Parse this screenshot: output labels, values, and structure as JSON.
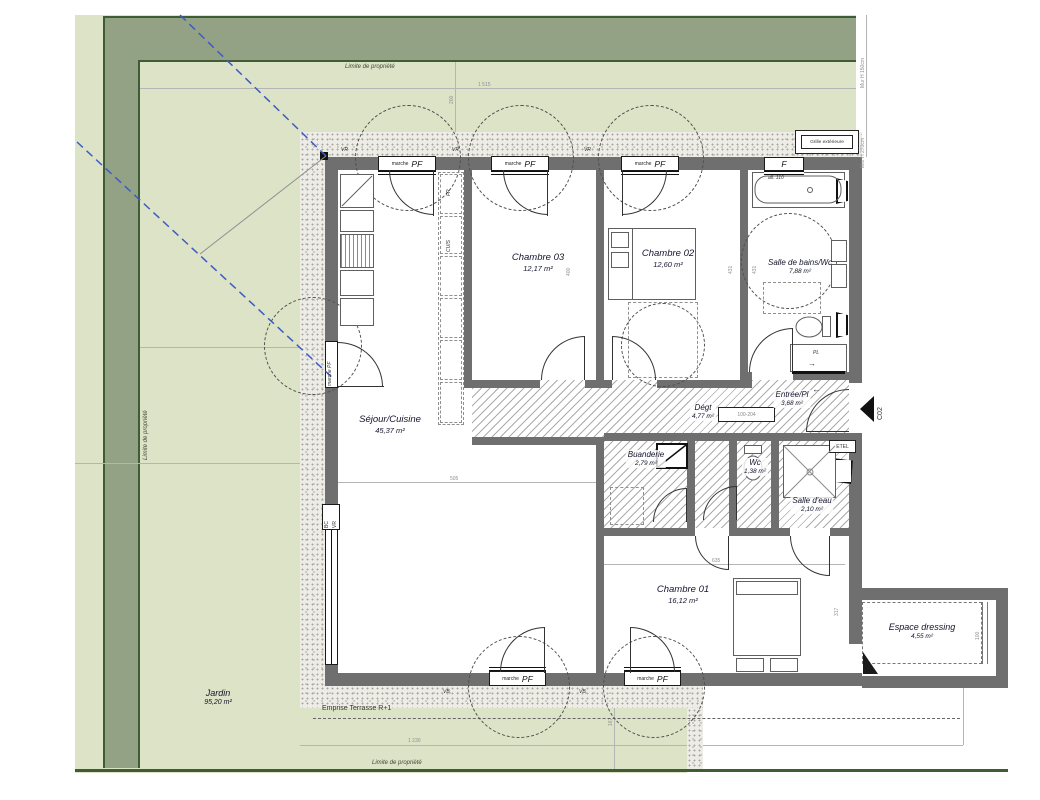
{
  "garden": {
    "name": "Jardin",
    "area": "95,20 m²"
  },
  "property_limit": {
    "top": "Limite de propriété",
    "left": "Limite de propriété",
    "bottom": "Limite de propriété"
  },
  "terrace": {
    "emprise_label": "Emprise Terrasse R+1"
  },
  "rooms": {
    "sejour": {
      "name": "Séjour/Cuisine",
      "area": "45,37 m²"
    },
    "chambre03": {
      "name": "Chambre 03",
      "area": "12,17 m²"
    },
    "chambre02": {
      "name": "Chambre 02",
      "area": "12,60 m²"
    },
    "sdb": {
      "name": "Salle de bains/Wc",
      "area": "7,88 m²"
    },
    "degagement": {
      "name": "Dégt",
      "area": "4,77 m²"
    },
    "entree": {
      "name": "Entrée/Pl",
      "area": "3,68 m²"
    },
    "buanderie": {
      "name": "Buanderie",
      "area": "2,79 m²"
    },
    "wc": {
      "name": "Wc",
      "area": "1,38 m²"
    },
    "salle_eau": {
      "name": "Salle d'eau",
      "area": "2,10 m²"
    },
    "chambre01": {
      "name": "Chambre 01",
      "area": "16,12 m²"
    },
    "dressing": {
      "name": "Espace dressing",
      "area": "4,55 m²"
    }
  },
  "openings": {
    "pf": "PF",
    "marche": "marche",
    "f": "F",
    "vr": "VR",
    "vb": "VB",
    "bc": "BC",
    "marche_pf": "marche PF"
  },
  "annotations": {
    "grille": "Grille extérieure",
    "all110": "all. 110",
    "pl": "PL",
    "etel": "ETEL",
    "fr": "FR",
    "cuis": "CUIS",
    "co2": "C02",
    "door_code": "100-204",
    "mur_h_top": "Mur H 150cm",
    "mur_h_right": "Mur H 270cm",
    "arrow_in": "←",
    "arrow_pl": "→"
  },
  "dimensions": {
    "top": "1 515",
    "top_left": "200",
    "bottom": "1 230",
    "terrace_v": "167",
    "sejour_w": "505",
    "ch03_h": "400",
    "ch02_h": "431",
    "sdb_h": "431",
    "ch01_w": "635",
    "ch01_h": "317",
    "dressing_w": "100"
  },
  "colors": {
    "garden": "#dde3c6",
    "hedge": "#93a284",
    "hedge_line": "#3f5d34",
    "terrace": "#edece7",
    "wall": "#6f6f6f",
    "accent_blue": "#3c5cc5",
    "label": "#14142c"
  }
}
